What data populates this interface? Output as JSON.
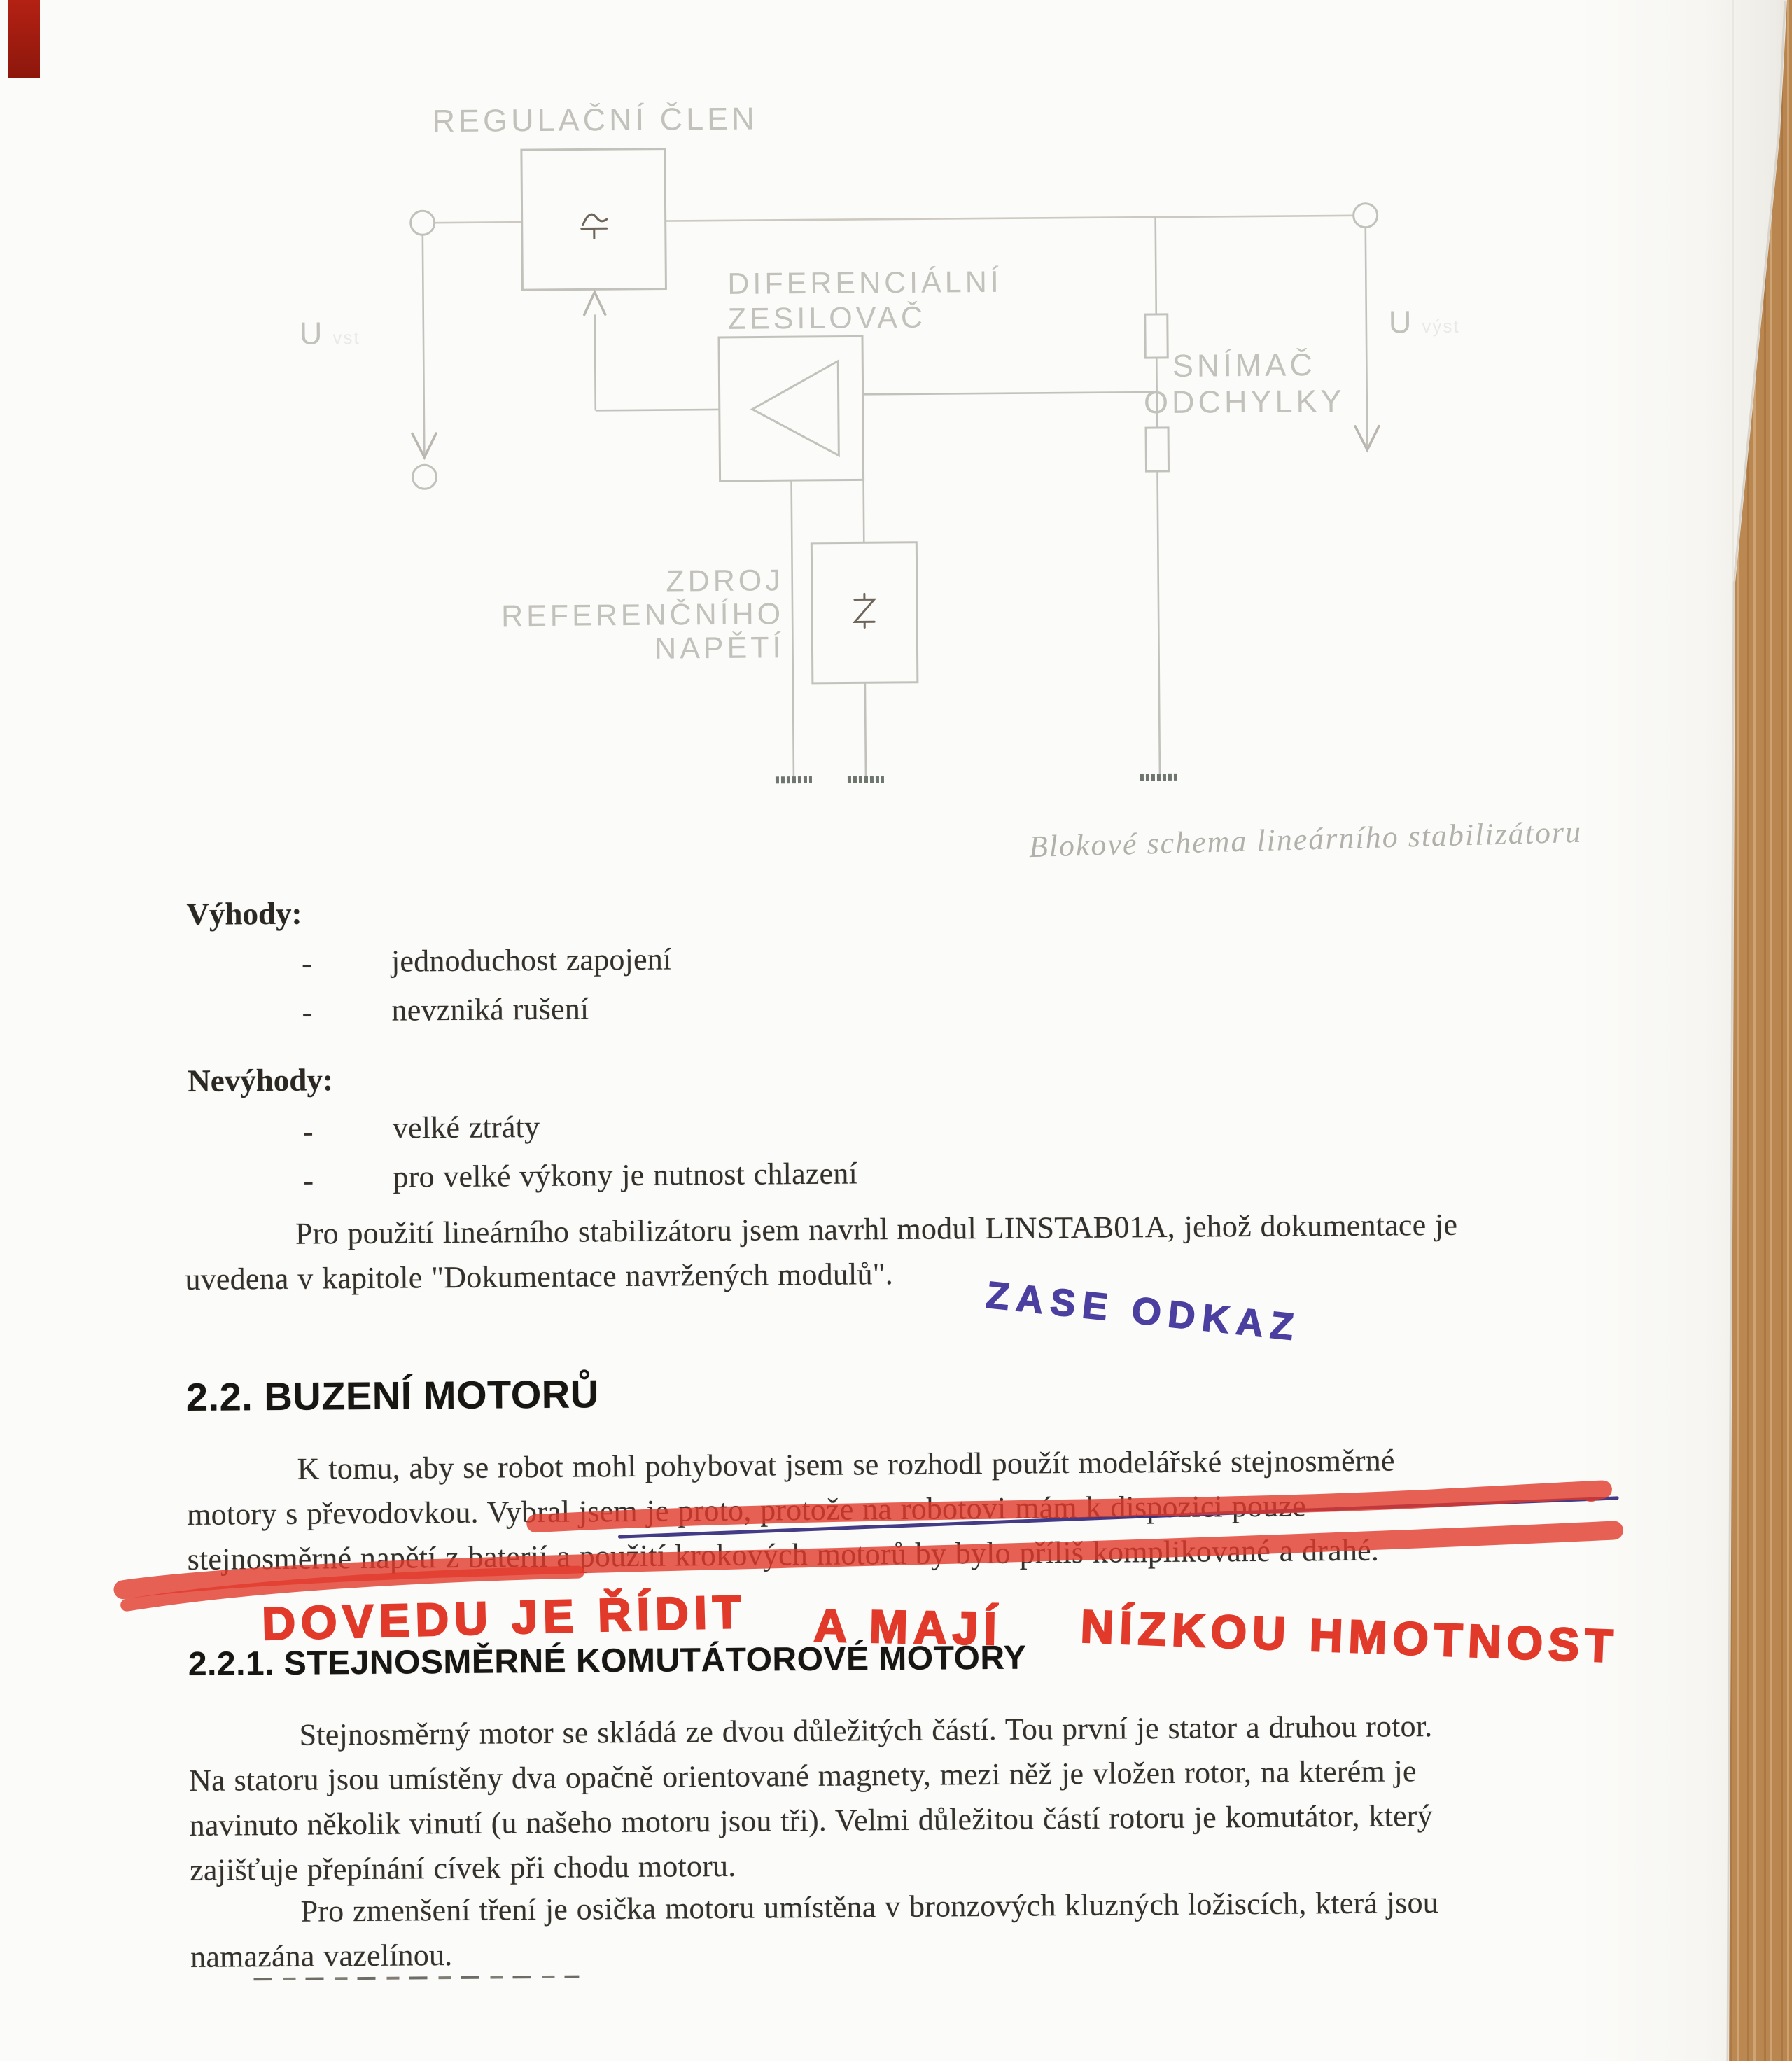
{
  "colors": {
    "ink": "#34312c",
    "diagram_gray": "#c2c1bb",
    "caption_gray": "#b2b0aa",
    "red_marker": "#e23a2a",
    "pen_blue": "#4b3fa0",
    "underline_blue": "#39307e"
  },
  "diagram": {
    "regulator_label": "REGULAČNÍ ČLEN",
    "diff_amp_label_1": "DIFERENCIÁLNÍ",
    "diff_amp_label_2": "ZESILOVAČ",
    "sensor_label_1": "SNÍMAČ",
    "sensor_label_2": "ODCHYLKY",
    "ref_label_1": "ZDROJ",
    "ref_label_2": "REFERENČNÍHO",
    "ref_label_3": "NAPĚTÍ",
    "u_in": "U",
    "u_in_sub": "vst",
    "u_out": "U",
    "u_out_sub": "výst",
    "caption": "Blokové schema lineárního stabilizátoru"
  },
  "advantages": {
    "title": "Výhody:",
    "bullet": "-",
    "items": [
      "jednoduchost zapojení",
      "nevzniká rušení"
    ]
  },
  "disadvantages": {
    "title": "Nevýhody:",
    "bullet": "-",
    "items": [
      "velké ztráty",
      "pro velké výkony je nutnost chlazení"
    ]
  },
  "paragraph_stabilizer": {
    "lines": [
      "Pro použití lineárního stabilizátoru jsem navrhl modul LINSTAB01A, jehož dokumentace je",
      "uvedena v kapitole \"Dokumentace navržených modulů\"."
    ]
  },
  "handwriting": {
    "blue_note": "ZASE ODKAZ",
    "red_note_1": "DOVEDU JE ŘÍDIT",
    "red_note_2": "A MAJÍ",
    "red_note_3": "NÍZKOU HMOTNOST"
  },
  "section_motors": {
    "heading": "2.2. BUZENÍ MOTORŮ",
    "lines": [
      "K tomu, aby se robot mohl pohybovat jsem se rozhodl použít modelářské stejnosměrné",
      "motory s převodovkou. Vybral jsem je proto, protože na robotovi mám k dispozici pouze",
      "stejnosměrné napětí z baterií a použití krokových motorů by bylo příliš komplikované a drahé."
    ]
  },
  "section_dc_motors": {
    "heading": "2.2.1. STEJNOSMĚRNÉ KOMUTÁTOROVÉ MOTORY",
    "para1_lines": [
      "Stejnosměrný motor se skládá ze dvou důležitých částí. Tou první je stator a druhou rotor.",
      "Na statoru jsou umístěny dva opačně orientované magnety, mezi něž je vložen rotor, na kterém je",
      "navinuto několik vinutí (u našeho motoru jsou tři). Velmi důležitou částí rotoru je komutátor, který",
      "zajišťuje přepínání cívek při chodu motoru."
    ],
    "para2_lines": [
      "Pro zmenšení tření je osička motoru umístěna v bronzových kluzných ložiscích, která jsou",
      "namazána vazelínou."
    ]
  }
}
